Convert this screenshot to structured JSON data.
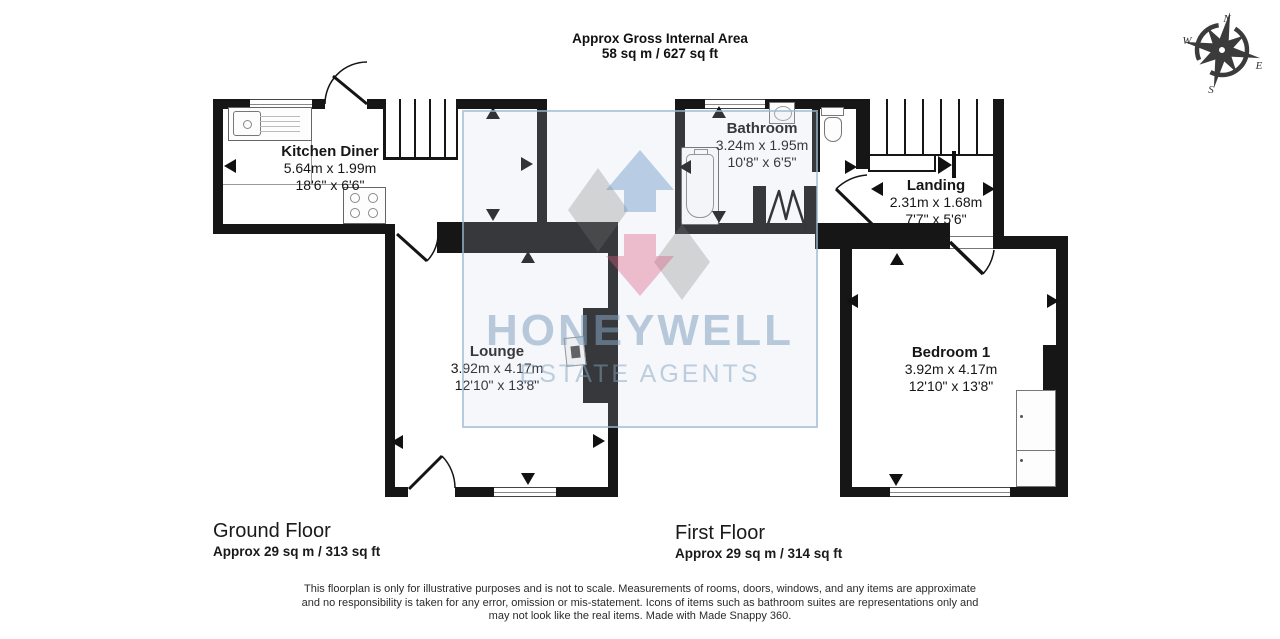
{
  "header": {
    "line1": "Approx Gross Internal Area",
    "line2": "58 sq m / 627 sq ft"
  },
  "compass": {
    "north": "N",
    "east": "E",
    "south": "S",
    "west": "W"
  },
  "watermark": {
    "brand": "HONEYWELL",
    "tagline": "ESTATE AGENTS"
  },
  "ground_floor": {
    "label": "Ground Floor",
    "area": "Approx 29 sq m / 313 sq ft",
    "rooms": {
      "kitchen": {
        "name": "Kitchen Diner",
        "metric": "5.64m x 1.99m",
        "imperial": "18'6\" x 6'6\""
      },
      "lounge": {
        "name": "Lounge",
        "metric": "3.92m x 4.17m",
        "imperial": "12'10\" x 13'8\""
      }
    }
  },
  "first_floor": {
    "label": "First Floor",
    "area": "Approx 29 sq m / 314 sq ft",
    "rooms": {
      "bathroom": {
        "name": "Bathroom",
        "metric": "3.24m x 1.95m",
        "imperial": "10'8\" x 6'5\""
      },
      "landing": {
        "name": "Landing",
        "metric": "2.31m x 1.68m",
        "imperial": "7'7\" x 5'6\""
      },
      "bedroom1": {
        "name": "Bedroom 1",
        "metric": "3.92m x 4.17m",
        "imperial": "12'10\" x 13'8\""
      }
    }
  },
  "disclaimer": {
    "line1": "This floorplan is only for illustrative purposes and is not to scale. Measurements of rooms, doors, windows, and any items are approximate",
    "line2": "and no responsibility is taken for any error, omission or mis-statement. Icons of items such as bathroom suites are representations only and",
    "line3": "may not look like the real items. Made with Made Snappy 360."
  },
  "colors": {
    "wall": "#161616",
    "brand_blue": "#b9cede",
    "logo_blue": "#c3d4e8",
    "logo_pink": "#f5c3d0"
  }
}
